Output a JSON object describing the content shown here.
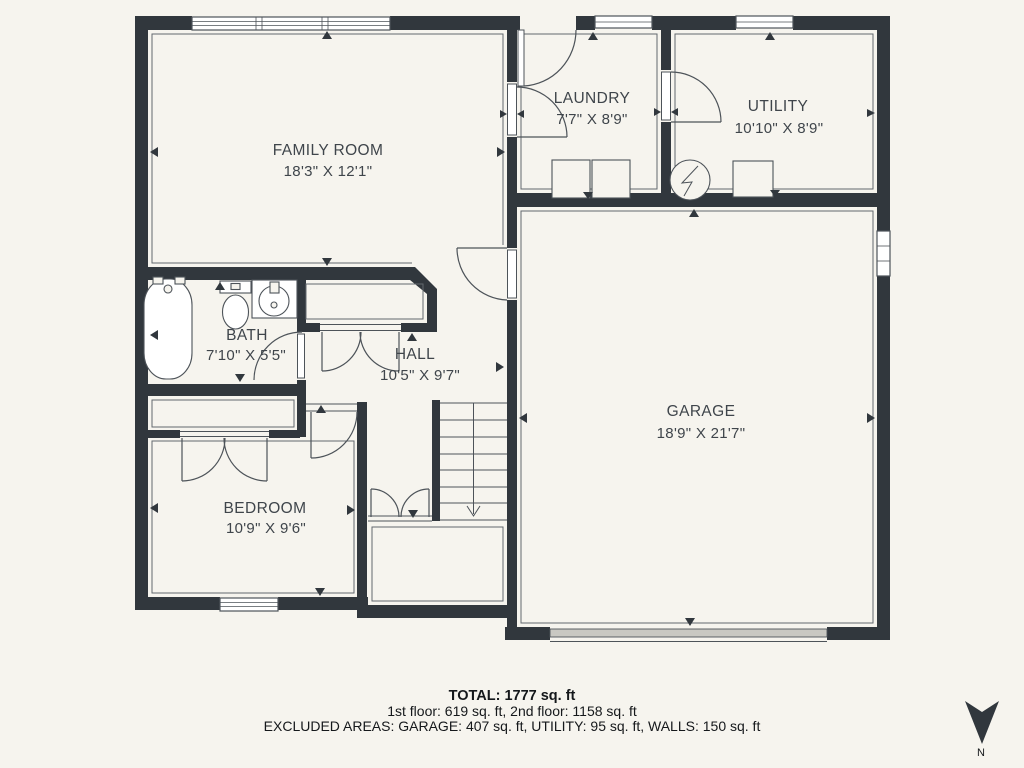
{
  "rooms": [
    {
      "name": "FAMILY ROOM",
      "dims": "18'3\" X 12'1\""
    },
    {
      "name": "LAUNDRY",
      "dims": "7'7\" X 8'9\""
    },
    {
      "name": "UTILITY",
      "dims": "10'10\" X 8'9\""
    },
    {
      "name": "BATH",
      "dims": "7'10\" X 5'5\""
    },
    {
      "name": "HALL",
      "dims": "10'5\" X 9'7\""
    },
    {
      "name": "GARAGE",
      "dims": "18'9\" X 21'7\""
    },
    {
      "name": "BEDROOM",
      "dims": "10'9\" X 9'6\""
    }
  ],
  "summary": {
    "total": "TOTAL: 1777 sq. ft",
    "floors": "1st floor: 619 sq. ft, 2nd floor: 1158 sq. ft",
    "excluded": "EXCLUDED AREAS: GARAGE: 407 sq. ft, UTILITY: 95 sq. ft, WALLS: 150 sq. ft"
  },
  "compass": {
    "label": "N"
  },
  "colors": {
    "wall": "#31373d",
    "background": "#f6f4ee",
    "line_color": "#4d5359",
    "garage_door": "#c9c8c2",
    "room_text": "#3f454b",
    "footer_text": "#15181b"
  }
}
